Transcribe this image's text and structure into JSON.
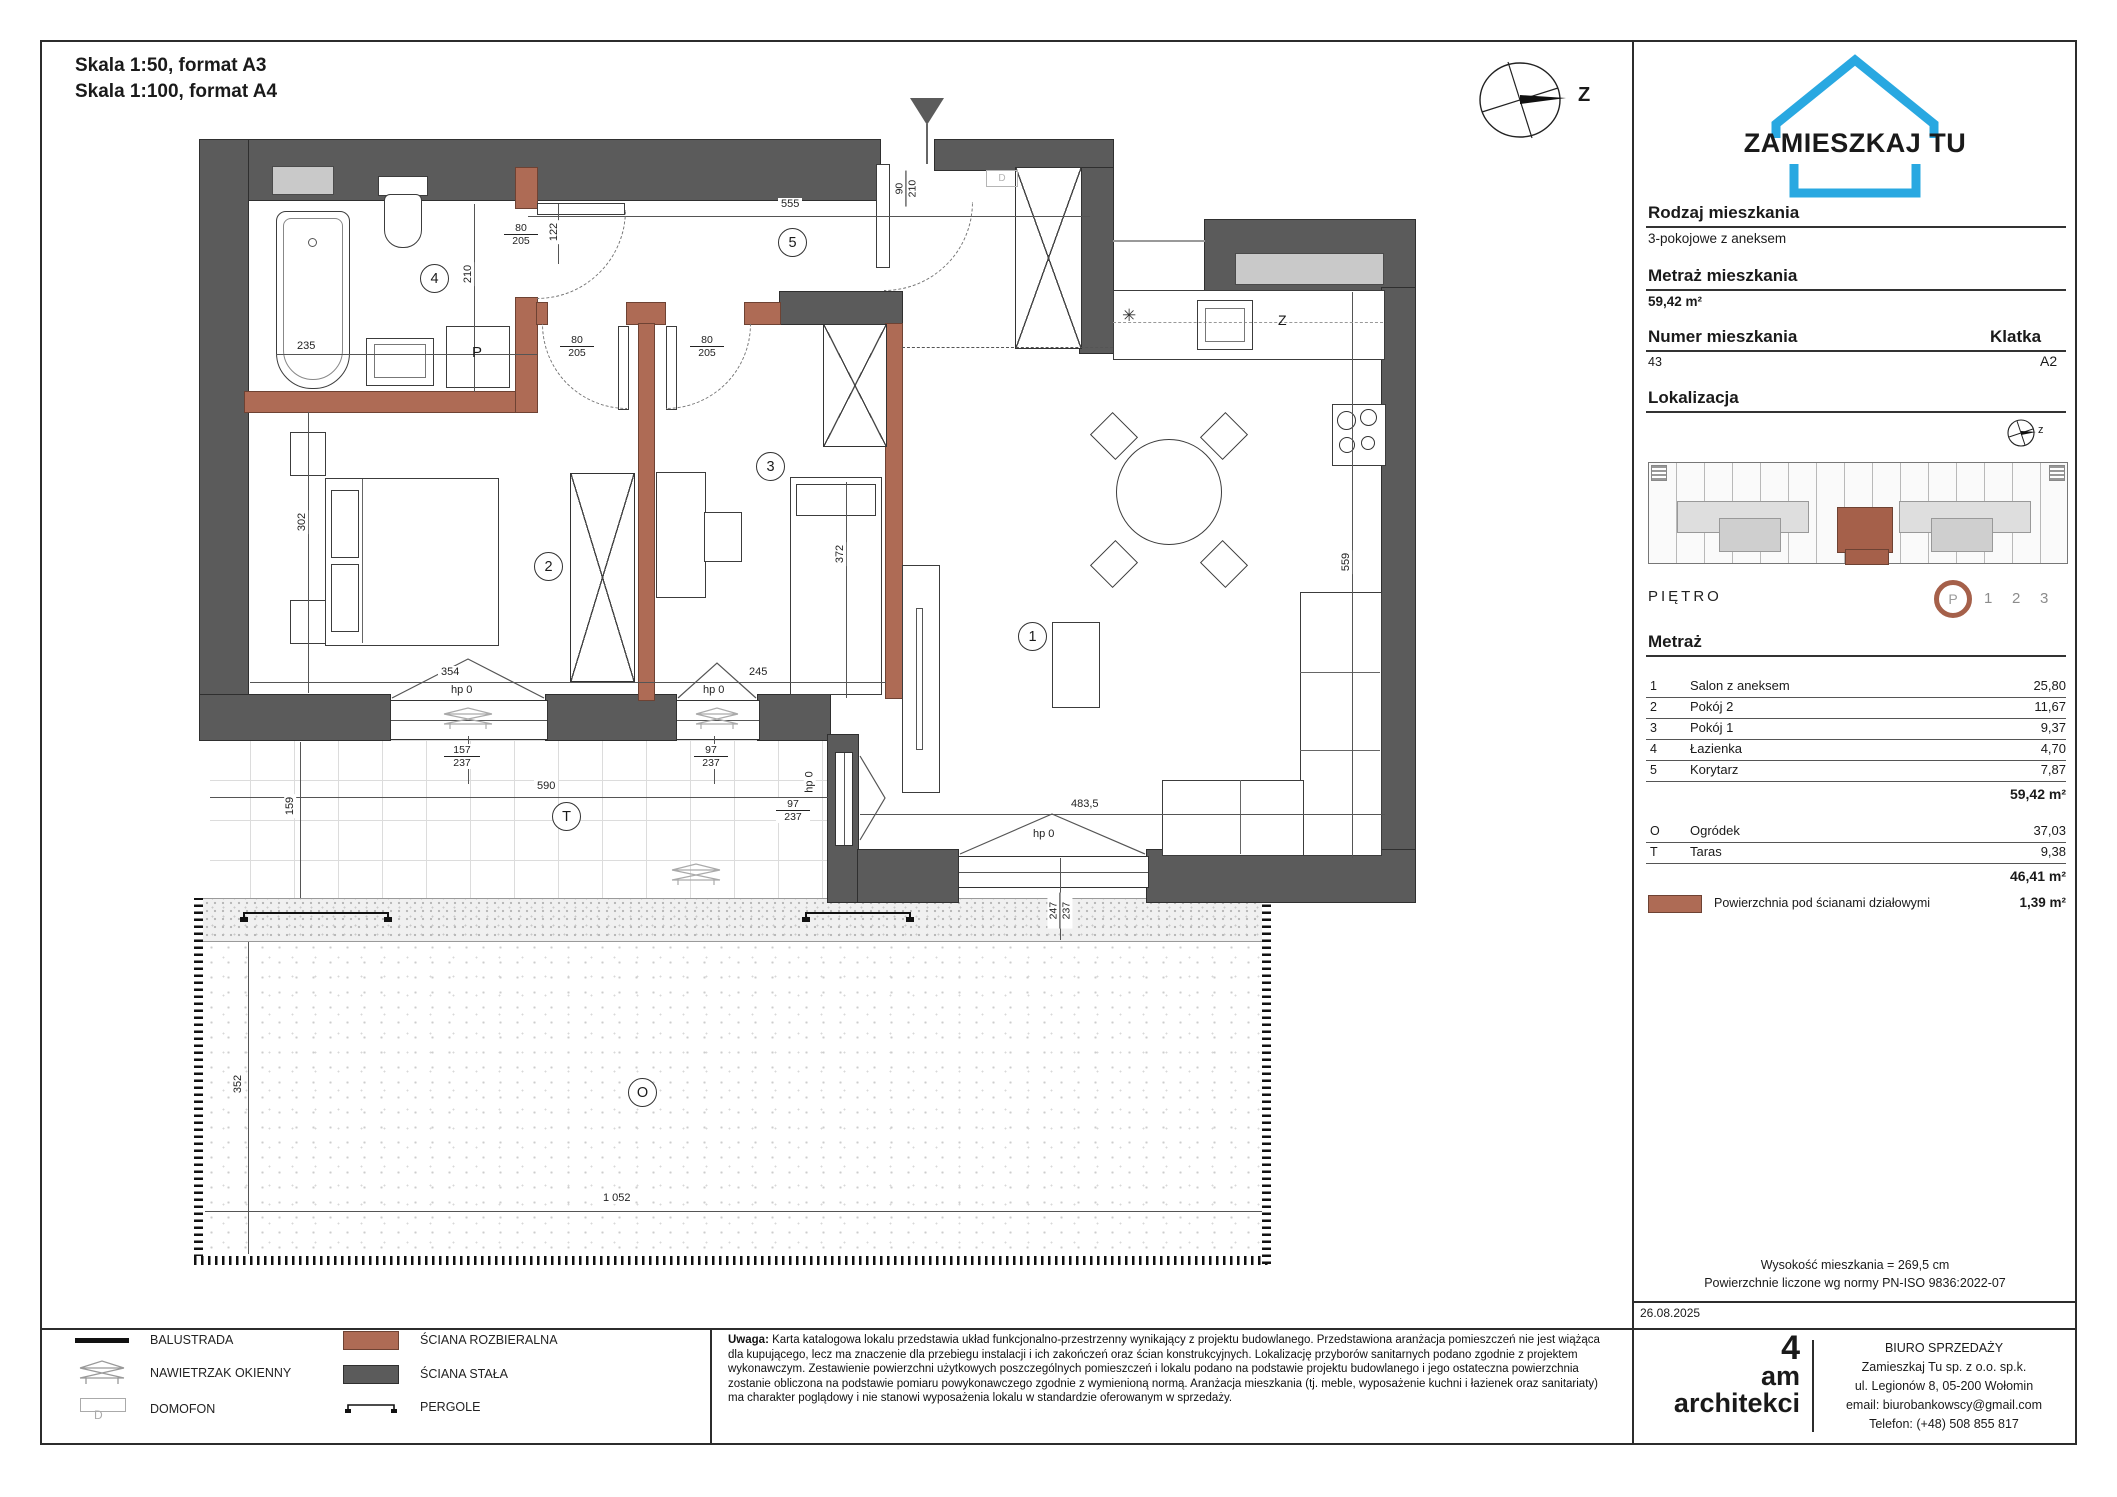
{
  "header": {
    "scale_line1": "Skala 1:50, format A3",
    "scale_line2": "Skala 1:100, format A4"
  },
  "brand": {
    "logo_text": "ZAMIESZKAJ TU",
    "logo_color": "#29a8e1"
  },
  "sidebar": {
    "rodzaj": {
      "label": "Rodzaj mieszkania",
      "value": "3-pokojowe z aneksem"
    },
    "metraz": {
      "label": "Metraż mieszkania",
      "value": "59,42 m²"
    },
    "numer": {
      "label": "Numer mieszkania",
      "value": "43"
    },
    "klatka": {
      "label": "Klatka",
      "value": "A2"
    },
    "lokalizacja": {
      "label": "Lokalizacja"
    },
    "pietro": {
      "label": "PIĘTRO",
      "current": "P",
      "other_floors": [
        "1",
        "2",
        "3"
      ]
    },
    "metraz_table": {
      "heading": "Metraż",
      "rows": [
        {
          "no": "1",
          "name": "Salon z aneksem",
          "area": "25,80"
        },
        {
          "no": "2",
          "name": "Pokój 2",
          "area": "11,67"
        },
        {
          "no": "3",
          "name": "Pokój 1",
          "area": "9,37"
        },
        {
          "no": "4",
          "name": "Łazienka",
          "area": "4,70"
        },
        {
          "no": "5",
          "name": "Korytarz",
          "area": "7,87"
        }
      ],
      "total": "59,42 m²",
      "outdoor": [
        {
          "no": "O",
          "name": "Ogródek",
          "area": "37,03"
        },
        {
          "no": "T",
          "name": "Taras",
          "area": "9,38"
        }
      ],
      "outdoor_total": "46,41 m²"
    },
    "partition_row": {
      "label": "Powierzchnia pod ścianami działowymi",
      "value": "1,39 m²"
    },
    "height_note": "Wysokość mieszkania =  269,5 cm",
    "norm_note": "Powierzchnie liczone wg normy PN-ISO 9836:2022-07"
  },
  "plan": {
    "compass_label": "Z",
    "compass_small_label": "z",
    "room_numbers": {
      "salon": "1",
      "bedroom": "2",
      "room1": "3",
      "bathroom": "4",
      "hall": "5"
    },
    "area_marks": {
      "terrace": "T",
      "garden": "O"
    },
    "fixtures": {
      "washer": "P",
      "dishwasher": "Z",
      "intercom": "D",
      "vent_symbol": "✳"
    },
    "dims": {
      "hall_width": "555",
      "entry_w": "90",
      "entry_h": "210",
      "door_w": "80",
      "door_h": "205",
      "bath_door_offset": "122",
      "bath_width": "235",
      "bath_depth": "210",
      "bedroom_depth": "302",
      "bedroom_width": "354",
      "room1_width": "245",
      "room1_bed": "372",
      "salon_depth": "559",
      "salon_width": "483,5",
      "win_bedroom_w": "157",
      "sill_h": "237",
      "win_small_w": "97",
      "balcony_w": "247",
      "terrace_width": "590",
      "terrace_depth": "159",
      "garden_depth": "352",
      "garden_width": "1 052",
      "sill_zero": "hp 0"
    }
  },
  "footer": {
    "date": "26.08.2025",
    "legend": [
      {
        "label": "BALUSTRADA"
      },
      {
        "label": "NAWIETRZAK OKIENNY"
      },
      {
        "label": "DOMOFON"
      },
      {
        "label": "ŚCIANA ROZBIERALNA"
      },
      {
        "label": "ŚCIANA STAŁA"
      },
      {
        "label": "PERGOLE"
      }
    ],
    "note_label": "Uwaga:",
    "note_text": "Karta katalogowa lokalu przedstawia układ funkcjonalno-przestrzenny wynikający z projektu budowlanego. Przedstawiona aranżacja pomieszczeń nie jest wiążąca dla kupującego, lecz ma znaczenie dla przebiegu instalacji i ich zakończeń oraz ścian konstrukcyjnych. Lokalizację przyborów sanitarnych podano zgodnie z projektem wykonawczym. Zestawienie powierzchni użytkowych poszczególnych pomieszczeń i lokalu podano na podstawie projektu budowlanego i jego ostateczna powierzchnia zostanie obliczona na podstawie pomiaru powykonawczego zgodnie z wymienioną normą. Aranżacja mieszkania (tj. meble, wyposażenie kuchni i łazienek oraz sanitariaty) ma charakter poglądowy i nie stanowi wyposażenia lokalu w standardzie oferowanym w sprzedaży.",
    "architect_logo": {
      "line1": "4",
      "line2": "am",
      "line3": "architekci"
    },
    "office": {
      "title": "BIURO SPRZEDAŻY",
      "company": "Zamieszkaj Tu sp. z o.o. sp.k.",
      "address": "ul. Legionów 8, 05-200 Wołomin",
      "email": "email: biurobankowscy@gmail.com",
      "phone": "Telefon: (+48) 508 855 817"
    }
  }
}
